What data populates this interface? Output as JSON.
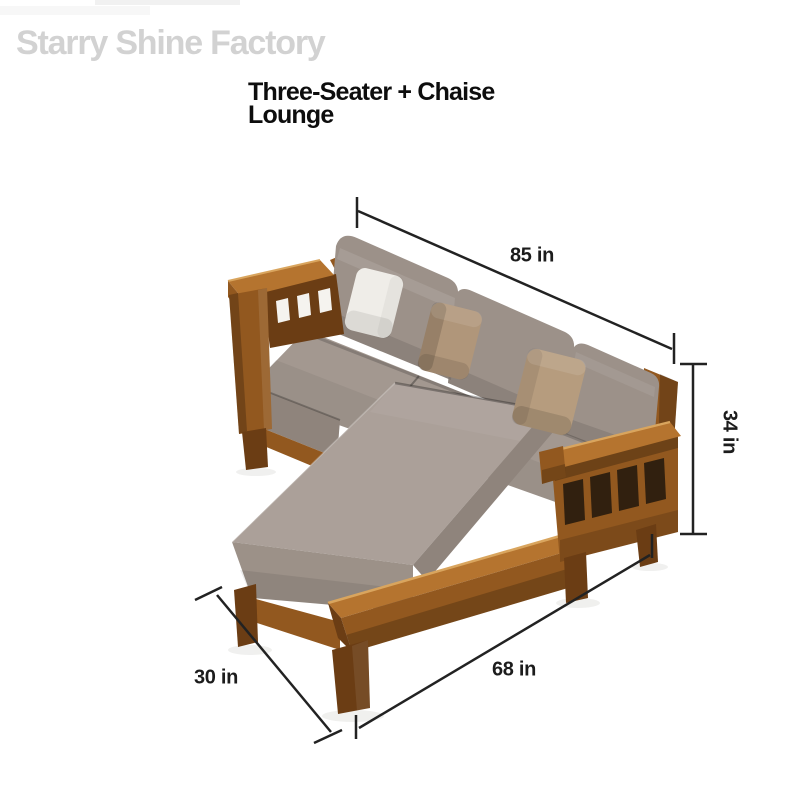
{
  "watermark": {
    "text": "Starry Shine Factory"
  },
  "title": {
    "line1": "Three-Seater + Chaise",
    "line2": "Lounge"
  },
  "dimension_labels": {
    "back_width": "85 in",
    "back_height": "34 in",
    "chaise_depth": "30 in",
    "front_length": "68 in"
  },
  "colors": {
    "background": "#ffffff",
    "dimension_line": "#222222",
    "dimension_text": "#1c1c1c",
    "title_text": "#0d0d0d",
    "watermark_text": "#d2d2d2",
    "wood_light": "#b5742f",
    "wood_mid": "#92581f",
    "wood_dark": "#6b3d14",
    "wood_highlight": "#d9a55e",
    "cubby_shadow": "#31200f",
    "slat_opening": "#f5f3ef",
    "fabric_backrest": "#9c9189",
    "fabric_seat": "#a39890",
    "fabric_seat_front": "#8f847c",
    "fabric_chaise": "#aba099",
    "fabric_chaise_front": "#9c9188",
    "pillow_white": "#efede8",
    "pillow_tan_middle": "#b0967a",
    "pillow_tan_right": "#b69c7e",
    "floor_shadow": "#ebebe9"
  }
}
